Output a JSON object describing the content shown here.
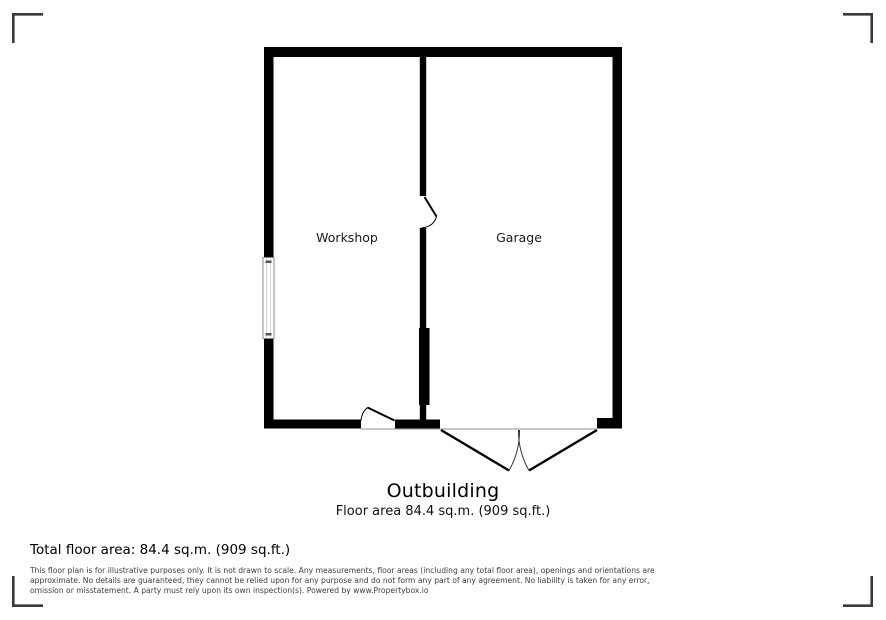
{
  "plan": {
    "rooms": [
      {
        "label": "Workshop"
      },
      {
        "label": "Garage"
      }
    ],
    "title": "Outbuilding",
    "area_caption": "Floor area 84.4 sq.m. (909 sq.ft.)"
  },
  "footer": {
    "total_area": "Total floor area: 84.4 sq.m. (909 sq.ft.)",
    "disclaimer_lines": [
      "This floor plan is for illustrative purposes only. It is not drawn to scale. Any measurements, floor areas (including any total floor area), openings and orientations are",
      "approximate. No details are guaranteed, they cannot be relied upon for any purpose and do not form any part of any agreement. No liability is taken for any error,",
      "omission or misstatement. A party must rely upon its own inspection(s). Powered by www.Propertybox.io"
    ]
  },
  "colors": {
    "wall": "#000000",
    "threshold_line": "#b3b3b3",
    "corner_mark": "#3a3a3a",
    "window_frame": "#888888",
    "background": "#ffffff"
  }
}
